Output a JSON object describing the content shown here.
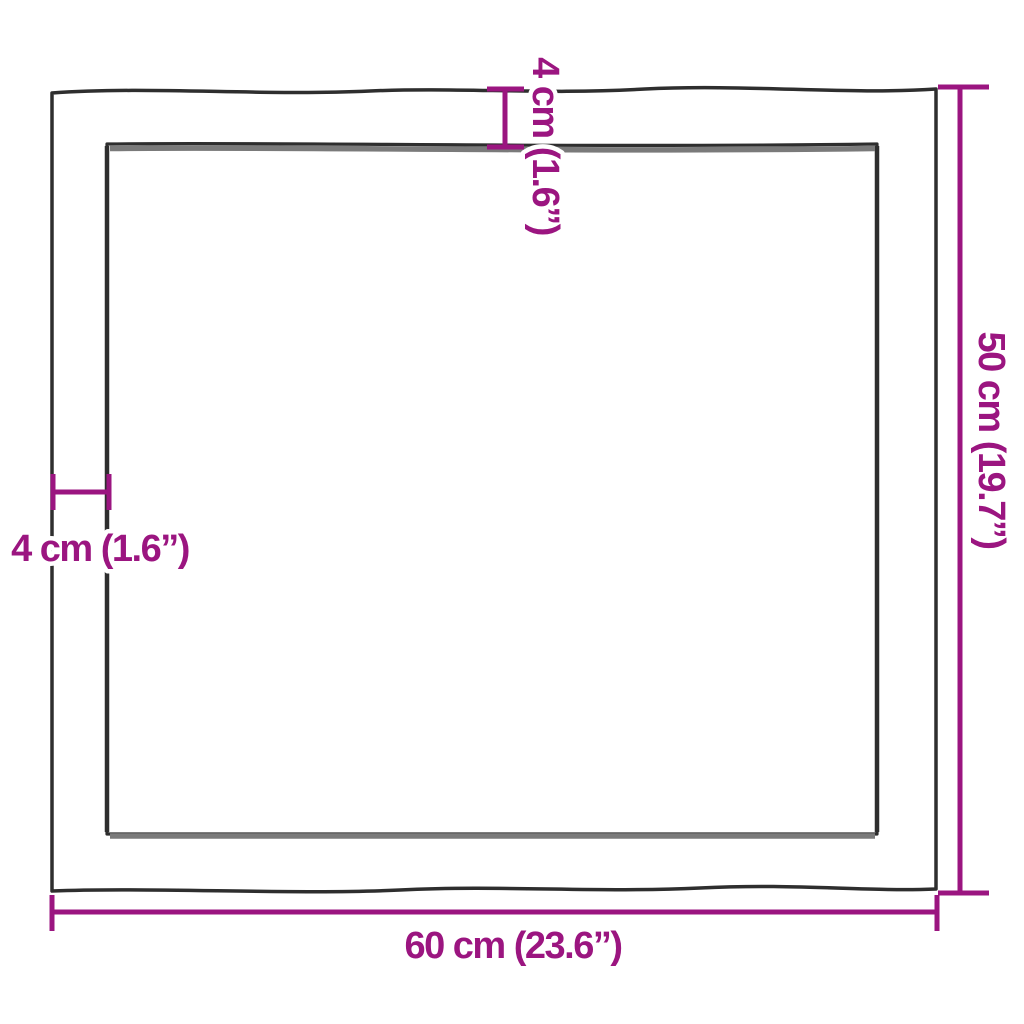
{
  "dimensions": {
    "width": {
      "label": "60 cm (23.6”)"
    },
    "height": {
      "label": "50 cm (19.7”)"
    },
    "thickness_top": {
      "label": "4 cm (1.6”)"
    },
    "thickness_left": {
      "label": "4 cm (1.6”)"
    }
  },
  "colors": {
    "accent": "#9B1580",
    "outline": "#2E2E2E",
    "bevel_shade": "#7A7A7A",
    "background": "#FFFFFF"
  }
}
